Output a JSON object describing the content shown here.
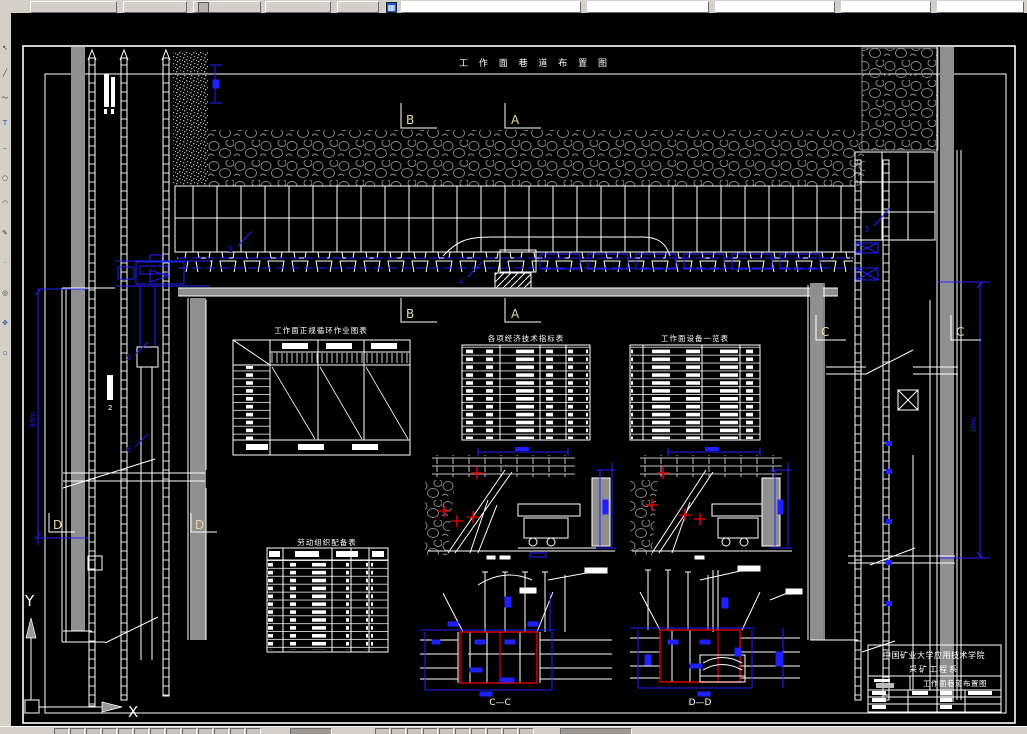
{
  "chrome": {
    "left_toolbar_icons": [
      "select-cursor-icon",
      "line-icon",
      "polyline-icon",
      "text-tool-icon",
      "dash-icon",
      "circle-icon",
      "arc-icon",
      "pencil-icon",
      "point-icon",
      "zoom-icon",
      "pan-icon",
      "grip-icon"
    ],
    "left_toolbar_glyphs": [
      "↖",
      "╱",
      "○",
      "T",
      "–",
      "○",
      "◜",
      "✎",
      "·",
      "◎",
      "✋",
      "□"
    ],
    "top_toolbar_icons": [
      "clipboard-icon",
      "grid-icon"
    ]
  },
  "drawing": {
    "title": "工 作 面 巷 道 布 置 图",
    "sections": {
      "a": "A",
      "b": "B",
      "c": "C",
      "d": "D"
    },
    "dims": {
      "left": "30m",
      "right": "30m"
    },
    "callouts": {
      "n1": "1",
      "n2": "2",
      "n3": "3",
      "n4": "4",
      "n5": "5",
      "n6": "6"
    },
    "tables": {
      "cycle": {
        "title": "工作面正规循环作业图表"
      },
      "economic": {
        "title": "各项经济技术指标表"
      },
      "equipment": {
        "title": "工作面设备一览表"
      },
      "labor": {
        "title": "劳动组织配备表"
      }
    },
    "details": {
      "cc": "C—C",
      "dd": "D—D"
    },
    "ucs": {
      "x": "X",
      "y": "Y"
    },
    "title_block": {
      "school": "中国矿业大学应用技术学院",
      "department": "采矿工程系",
      "drawing_name": "工作面巷道布置图"
    }
  },
  "colors": {
    "blue": "#2020ff",
    "red": "#d00000",
    "gray": "#8f8f8f",
    "bg": "#000000",
    "chrome": "#d4d0c8"
  }
}
